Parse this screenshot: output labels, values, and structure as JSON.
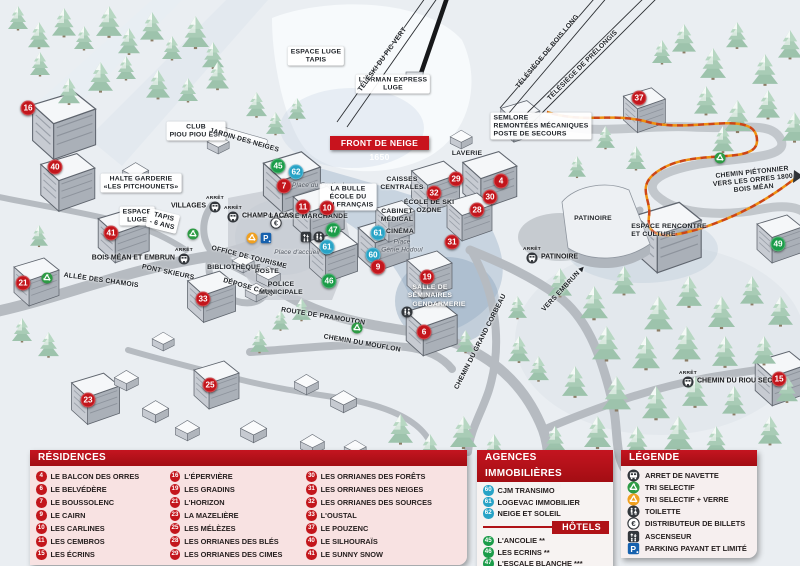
{
  "colors": {
    "marker_red": "#c3161c",
    "marker_blue": "#28a3c6",
    "marker_green": "#1b9c49",
    "header_red": "#b01217",
    "banner_red": "#c8131d"
  },
  "map": {
    "banner": "FRONT DE NEIGE 1650",
    "arret_label": "ARRÊT",
    "markers": [
      {
        "n": "16",
        "c": "red",
        "x": 28,
        "y": 108
      },
      {
        "n": "40",
        "c": "red",
        "x": 55,
        "y": 167
      },
      {
        "n": "41",
        "c": "red",
        "x": 111,
        "y": 233
      },
      {
        "n": "21",
        "c": "red",
        "x": 23,
        "y": 283
      },
      {
        "n": "33",
        "c": "red",
        "x": 203,
        "y": 299
      },
      {
        "n": "23",
        "c": "red",
        "x": 88,
        "y": 400
      },
      {
        "n": "25",
        "c": "red",
        "x": 210,
        "y": 385
      },
      {
        "n": "45",
        "c": "green",
        "x": 278,
        "y": 166
      },
      {
        "n": "62",
        "c": "blue",
        "x": 296,
        "y": 172
      },
      {
        "n": "7",
        "c": "red",
        "x": 284,
        "y": 186
      },
      {
        "n": "11",
        "c": "red",
        "x": 303,
        "y": 207
      },
      {
        "n": "10",
        "c": "red",
        "x": 327,
        "y": 208
      },
      {
        "n": "47",
        "c": "green",
        "x": 333,
        "y": 230
      },
      {
        "n": "61",
        "c": "blue",
        "x": 327,
        "y": 247
      },
      {
        "n": "61",
        "c": "blue",
        "x": 378,
        "y": 233
      },
      {
        "n": "60",
        "c": "blue",
        "x": 373,
        "y": 255
      },
      {
        "n": "9",
        "c": "red",
        "x": 378,
        "y": 267
      },
      {
        "n": "46",
        "c": "green",
        "x": 329,
        "y": 281
      },
      {
        "n": "19",
        "c": "red",
        "x": 427,
        "y": 277
      },
      {
        "n": "6",
        "c": "red",
        "x": 424,
        "y": 332
      },
      {
        "n": "29",
        "c": "red",
        "x": 456,
        "y": 179
      },
      {
        "n": "32",
        "c": "red",
        "x": 434,
        "y": 193
      },
      {
        "n": "4",
        "c": "red",
        "x": 501,
        "y": 181
      },
      {
        "n": "30",
        "c": "red",
        "x": 490,
        "y": 197
      },
      {
        "n": "28",
        "c": "red",
        "x": 477,
        "y": 210
      },
      {
        "n": "31",
        "c": "red",
        "x": 452,
        "y": 242
      },
      {
        "n": "37",
        "c": "red",
        "x": 639,
        "y": 98
      },
      {
        "n": "49",
        "c": "green",
        "x": 778,
        "y": 244
      },
      {
        "n": "15",
        "c": "red",
        "x": 779,
        "y": 379
      }
    ],
    "labels": [
      {
        "t": "L'ORMAN EXPRESS\nLUGE",
        "x": 393,
        "y": 84,
        "b": 1
      },
      {
        "t": "TÉLÉSKI DU PIC VERT",
        "x": 383,
        "y": 60,
        "r": -54
      },
      {
        "t": "TÉLÉSIÈGE DE BOIS LONG",
        "x": 548,
        "y": 52,
        "r": -50
      },
      {
        "t": "TÉLÉSIÈGE DE PRÉLONGIS",
        "x": 583,
        "y": 66,
        "r": -45
      },
      {
        "t": "SEMLORE\nREMONTÉES MÉCANIQUES\nPOSTE DE SECOURS",
        "x": 541,
        "y": 126,
        "b": 1,
        "a": "left"
      },
      {
        "t": "ESPACE LUGE\nTAPIS",
        "x": 316,
        "y": 56,
        "b": 1
      },
      {
        "t": "CLUB\nPIOU PIOU ESF",
        "x": 196,
        "y": 131,
        "b": 1
      },
      {
        "t": "JARDIN DES NEIGES",
        "x": 244,
        "y": 141,
        "r": 16
      },
      {
        "t": "HALTE GARDERIE\n«LES PITCHOUNETS»",
        "x": 141,
        "y": 183,
        "b": 1
      },
      {
        "t": "ESPACE\nLUGE",
        "x": 137,
        "y": 216,
        "b": 1
      },
      {
        "t": "TAPIS\n- 6 ANS",
        "x": 163,
        "y": 221,
        "r": 14,
        "b": 1
      },
      {
        "t": "Place du Festival",
        "x": 318,
        "y": 186,
        "v": "it"
      },
      {
        "t": "LA BULLE\nÉCOLE DU\nSKI FRANÇAIS",
        "x": 348,
        "y": 197,
        "b": 1
      },
      {
        "t": "GALERIE MARCHANDE",
        "x": 308,
        "y": 217
      },
      {
        "t": "CAISSES\nCENTRALES",
        "x": 402,
        "y": 184
      },
      {
        "t": "LAVERIE",
        "x": 467,
        "y": 154
      },
      {
        "t": "ÉCOLE DE SKI\nOZONE",
        "x": 429,
        "y": 207
      },
      {
        "t": "CABINET\nMÉDICAL",
        "x": 397,
        "y": 216
      },
      {
        "t": "CINÉMA",
        "x": 400,
        "y": 232
      },
      {
        "t": "Place\nGénie Hodoul",
        "x": 402,
        "y": 246,
        "v": "it"
      },
      {
        "t": "OFFICE DE TOURISME",
        "x": 249,
        "y": 258,
        "r": 14
      },
      {
        "t": "BIBLIOTHÈQUE",
        "x": 234,
        "y": 268
      },
      {
        "t": "POSTE",
        "x": 267,
        "y": 272
      },
      {
        "t": "DÉPOSE CARS",
        "x": 248,
        "y": 288,
        "r": 16
      },
      {
        "t": "POLICE\nMUNICIPALE",
        "x": 281,
        "y": 289
      },
      {
        "t": "Place d'accueil",
        "x": 297,
        "y": 253,
        "v": "it"
      },
      {
        "t": "PONT SKIEURS",
        "x": 168,
        "y": 273,
        "r": 12
      },
      {
        "t": "ALLÉE DES CHAMOIS",
        "x": 101,
        "y": 281,
        "r": 8
      },
      {
        "t": "ROUTE DE PRAMOUTON",
        "x": 323,
        "y": 317,
        "r": 9
      },
      {
        "t": "CHEMIN DU MOUFLON",
        "x": 362,
        "y": 344,
        "r": 10
      },
      {
        "t": "CHEMIN DU GRAND CORBEAU",
        "x": 481,
        "y": 342,
        "r": -63
      },
      {
        "t": "VERS EMBRUN ▶",
        "x": 564,
        "y": 289,
        "r": -47
      },
      {
        "t": "SALLE DE\nSÉMINAIRES",
        "x": 430,
        "y": 292,
        "v": "wh"
      },
      {
        "t": "GENDARMERIE",
        "x": 439,
        "y": 305,
        "v": "wh"
      },
      {
        "t": "PATINOIRE",
        "x": 593,
        "y": 219
      },
      {
        "t": "ESPACE RENCONTRE\nET CULTURE",
        "x": 669,
        "y": 231,
        "a": "left"
      },
      {
        "t": "CHEMIN PIÉTONNIER\nVERS LES ORRES 1800\nBOIS MÉAN",
        "x": 753,
        "y": 181,
        "r": -6
      }
    ],
    "bus_stops": [
      {
        "label": "VILLAGES",
        "x": 215,
        "y": 206,
        "side": "left"
      },
      {
        "label": "CHAMP LACAS",
        "x": 233,
        "y": 216,
        "side": "right"
      },
      {
        "label": "BOIS MÉAN ET EMBRUN",
        "x": 184,
        "y": 258,
        "side": "left"
      },
      {
        "label": "PATINOIRE",
        "x": 532,
        "y": 257,
        "side": "right"
      },
      {
        "label": "CHEMIN DU RIOU SEC",
        "x": 688,
        "y": 381,
        "side": "right"
      }
    ],
    "icons": [
      {
        "t": "recycle-green",
        "x": 193,
        "y": 233
      },
      {
        "t": "recycle-green",
        "x": 47,
        "y": 277
      },
      {
        "t": "recycle-green",
        "x": 357,
        "y": 327
      },
      {
        "t": "recycle-green",
        "x": 720,
        "y": 157
      },
      {
        "t": "recycle-orange",
        "x": 252,
        "y": 237
      },
      {
        "t": "parking",
        "x": 266,
        "y": 237
      },
      {
        "t": "euro",
        "x": 276,
        "y": 222
      },
      {
        "t": "elevator",
        "x": 306,
        "y": 236
      },
      {
        "t": "toilet",
        "x": 319,
        "y": 236
      },
      {
        "t": "toilet",
        "x": 407,
        "y": 311
      }
    ]
  },
  "panels": {
    "residences": {
      "title": "RÉSIDENCES",
      "columns": [
        [
          [
            "4",
            "LE BALCON DES ORRES"
          ],
          [
            "6",
            "LE BELVÉDÈRE"
          ],
          [
            "7",
            "LE BOUSSOLENC"
          ],
          [
            "9",
            "LE CAIRN"
          ],
          [
            "10",
            "LES CARLINES"
          ],
          [
            "11",
            "LES CEMBROS"
          ],
          [
            "15",
            "LES ÉCRINS"
          ]
        ],
        [
          [
            "16",
            "L'ÉPERVIÈRE"
          ],
          [
            "19",
            "LES GRADINS"
          ],
          [
            "21",
            "L'HORIZON"
          ],
          [
            "23",
            "LA MAZELIÈRE"
          ],
          [
            "25",
            "LES MÉLÈZES"
          ],
          [
            "28",
            "LES ORRIANES DES BLÉS"
          ],
          [
            "29",
            "LES ORRIANES DES CIMES"
          ]
        ],
        [
          [
            "30",
            "LES ORRIANES DES FORÊTS"
          ],
          [
            "31",
            "LES ORRIANES DES NEIGES"
          ],
          [
            "32",
            "LES ORRIANES DES SOURCES"
          ],
          [
            "33",
            "L'OUSTAL"
          ],
          [
            "37",
            "LE POUZENC"
          ],
          [
            "40",
            "LE SILHOURAÏS"
          ],
          [
            "41",
            "LE SUNNY SNOW"
          ]
        ]
      ]
    },
    "agences": {
      "title": "AGENCES IMMOBILIÈRES",
      "items": [
        [
          "60",
          "CJM TRANSIMO"
        ],
        [
          "61",
          "LOGEVAC IMMOBILIER"
        ],
        [
          "62",
          "NEIGE ET SOLEIL"
        ]
      ],
      "hotels_title": "HÔTELS",
      "hotels": [
        [
          "45",
          "L'ANCOLIE **"
        ],
        [
          "46",
          "LES ECRINS **"
        ],
        [
          "47",
          "L'ESCALE BLANCHE ***"
        ],
        [
          "49",
          "LES TRAPPEURS **"
        ]
      ]
    },
    "legende": {
      "title": "LÉGENDE",
      "items": [
        [
          "bus",
          "ARRET DE NAVETTE"
        ],
        [
          "recycle-green",
          "TRI SELECTIF"
        ],
        [
          "recycle-orange",
          "TRI SELECTIF + VERRE"
        ],
        [
          "toilet",
          "TOILETTE"
        ],
        [
          "euro",
          "DISTRIBUTEUR DE BILLETS"
        ],
        [
          "elevator",
          "ASCENSEUR"
        ],
        [
          "parking",
          "PARKING PAYANT ET LIMITÉ"
        ]
      ]
    }
  }
}
